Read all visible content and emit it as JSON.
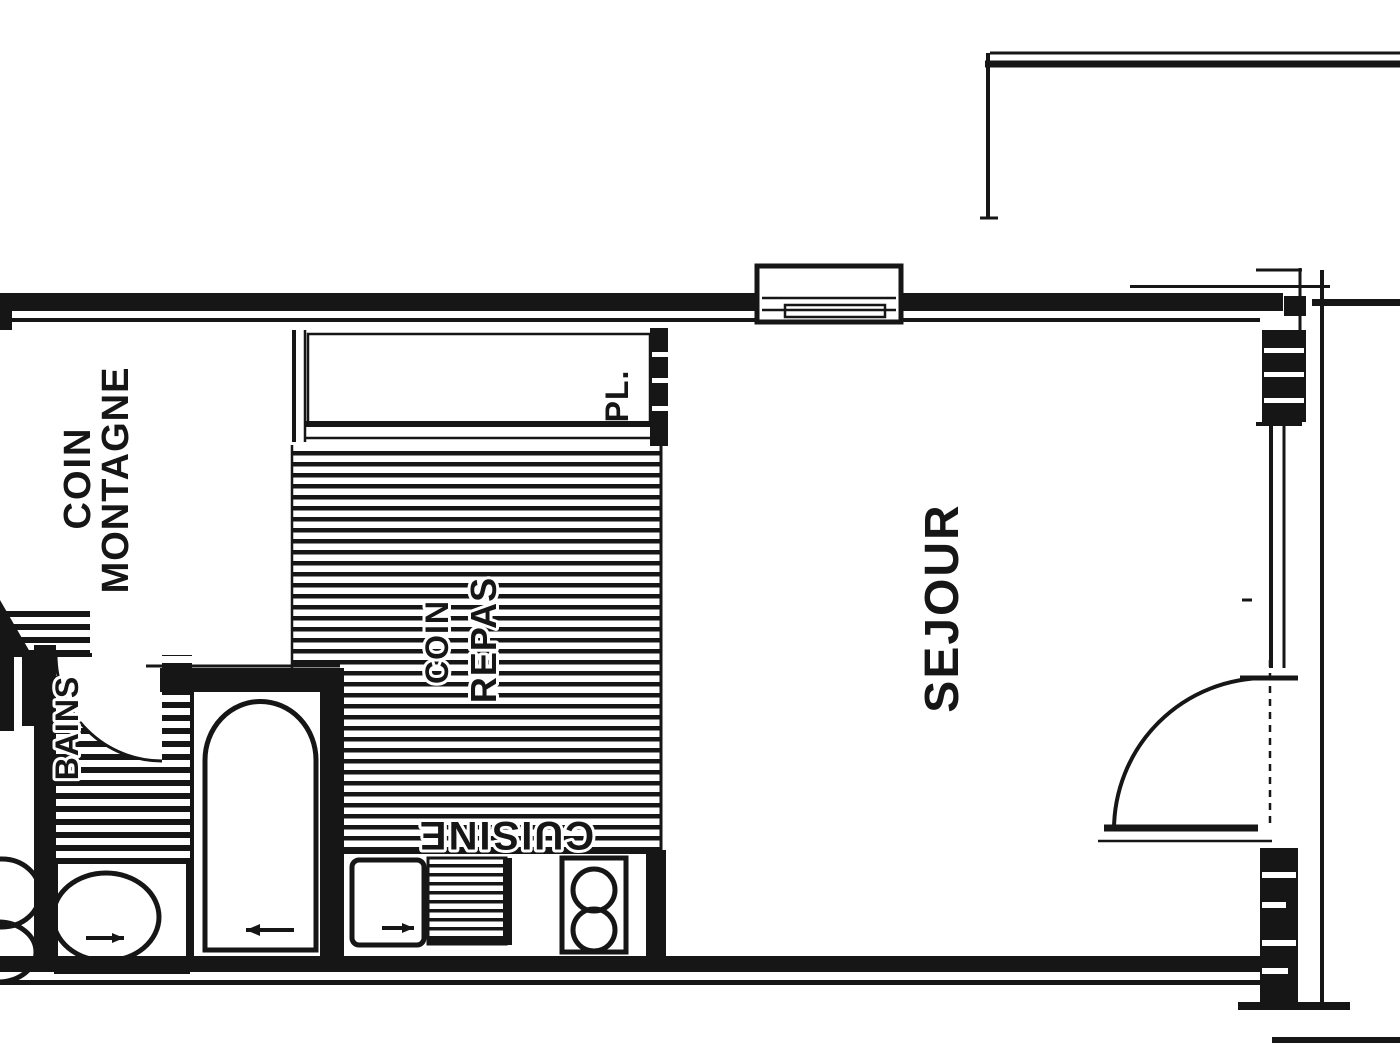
{
  "drawing": {
    "type": "apartment-floor-plan",
    "rooms": {
      "coin_montagne": {
        "line1": "COIN",
        "line2": "MONTAGNE"
      },
      "coin_repas": {
        "line1": "COIN",
        "line2": "REPAS"
      },
      "sejour": {
        "label": "SEJOUR"
      },
      "cuisine": {
        "label": "CUISINE"
      },
      "bains": {
        "label": "BAINS"
      },
      "placard": {
        "label": "PL."
      }
    },
    "colors": {
      "ink": "#161616",
      "paper": "#ffffff"
    }
  }
}
